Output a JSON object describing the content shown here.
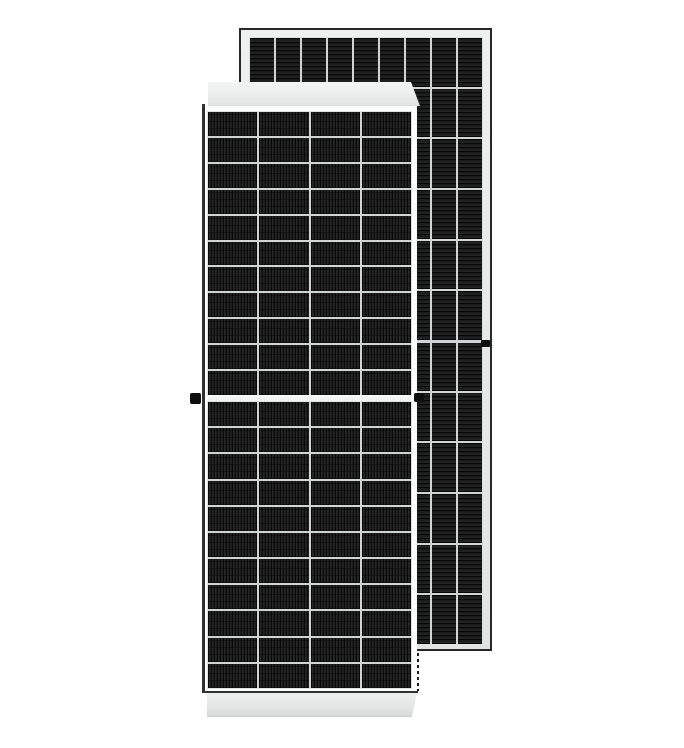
{
  "colors": {
    "background": "#ffffff",
    "metal_frame": "#e9ebeb",
    "glass_frame": "#fbfcfc",
    "divider": "#d0d4d4",
    "strip_top": "#eceded",
    "strip_bottom": "#e4e6e6",
    "outline_dark": "#282828",
    "outline_soft": "#303030",
    "connector": "#0d0d0d"
  },
  "back_panel": {
    "kind": "solar-panel-rear",
    "rows": 12,
    "columns": 9,
    "cell_texture": "horizontal-stripes",
    "mid_split_row": 6,
    "frame_mount_mark_side": "right"
  },
  "front_panel": {
    "kind": "solar-panel-front",
    "columns": 4,
    "cell_texture": "vertical-stripes",
    "half_cut_split": true,
    "top_half": {
      "rows": 11,
      "columns": 4
    },
    "bottom_half": {
      "rows": 11,
      "columns": 4
    },
    "grounding_lugs": [
      "left",
      "right"
    ]
  }
}
